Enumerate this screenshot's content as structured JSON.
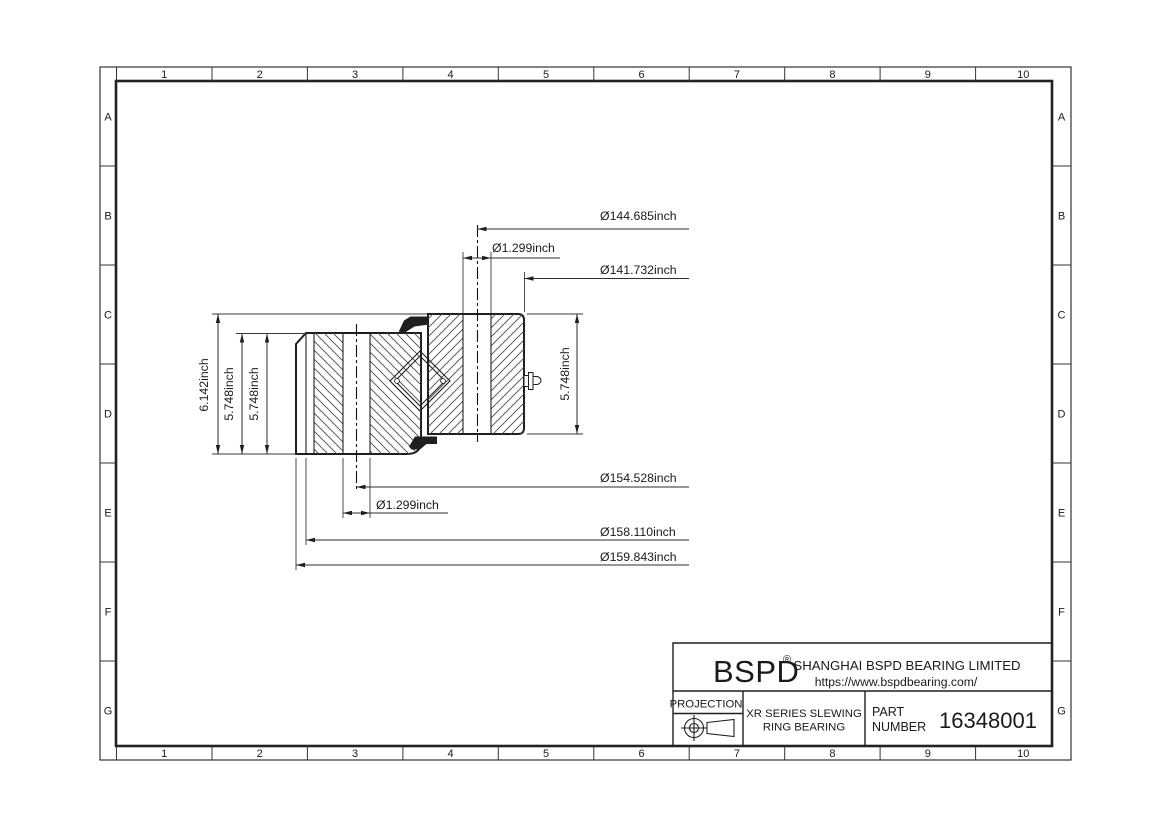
{
  "grid": {
    "cols": [
      "1",
      "2",
      "3",
      "4",
      "5",
      "6",
      "7",
      "8",
      "9",
      "10"
    ],
    "rows": [
      "A",
      "B",
      "C",
      "D",
      "E",
      "F",
      "G"
    ]
  },
  "dims": {
    "bcd_top": "Ø144.685inch",
    "hole_top": "Ø1.299inch",
    "bore": "Ø141.732inch",
    "bcd_bottom": "Ø154.528inch",
    "hole_bottom": "Ø1.299inch",
    "od_step": "Ø158.110inch",
    "od": "Ø159.843inch",
    "height_total": "6.142inch",
    "height_left_a": "5.748inch",
    "height_left_b": "5.748inch",
    "height_right": "5.748inch"
  },
  "title_block": {
    "brand": "BSPD",
    "reg_mark": "®",
    "company": "SHANGHAI BSPD BEARING LIMITED",
    "website": "https://www.bspdbearing.com/",
    "projection_label": "PROJECTION",
    "product_line1": "XR SERIES SLEWING",
    "product_line2": "RING BEARING",
    "part_label1": "PART",
    "part_label2": "NUMBER",
    "part_number": "16348001"
  }
}
